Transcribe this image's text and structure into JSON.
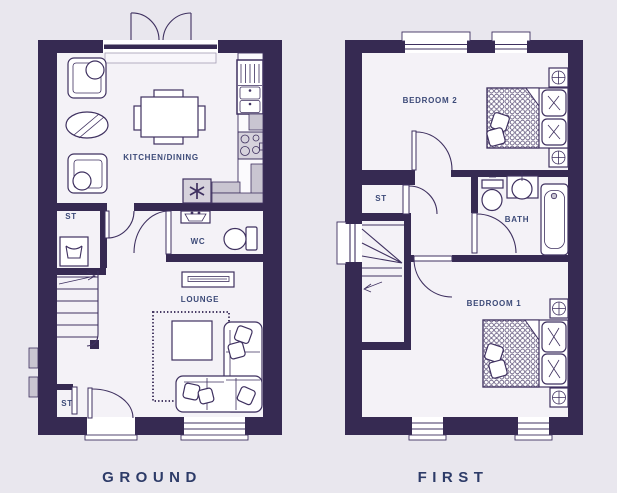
{
  "page": {
    "background_color": "#e9e7ee",
    "wall_color": "#362a52",
    "floor_color": "#f4f2f7",
    "line_color": "#3f3160",
    "appliance_gray": "#c9c5d1",
    "label_color": "#3c4a78",
    "title_color": "#2d3b68"
  },
  "floors": [
    {
      "title": "GROUND",
      "rooms": {
        "kitchen_dining": "KITCHEN/DINING",
        "store_hall": "ST",
        "wc": "WC",
        "lounge": "LOUNGE",
        "store_entry": "ST"
      },
      "fixtures": [
        "french-doors",
        "sink-drainer",
        "hob",
        "fridge-freezer",
        "washing-machine",
        "armchairs",
        "round-rug",
        "dining-table",
        "wc-basin",
        "toilet",
        "tv-unit",
        "corner-sofa",
        "coffee-table",
        "fringed-rug",
        "stairs-up",
        "front-door",
        "meter-boxes",
        "window"
      ]
    },
    {
      "title": "FIRST",
      "rooms": {
        "bedroom2": "BEDROOM 2",
        "store": "ST",
        "bath": "BATH",
        "bedroom1": "BEDROOM 1"
      },
      "fixtures": [
        "double-bed",
        "bedside-tables-with-lamps",
        "scatter-cushions",
        "toilet",
        "round-basin",
        "bathtub",
        "winder-stairs",
        "windows"
      ]
    }
  ]
}
